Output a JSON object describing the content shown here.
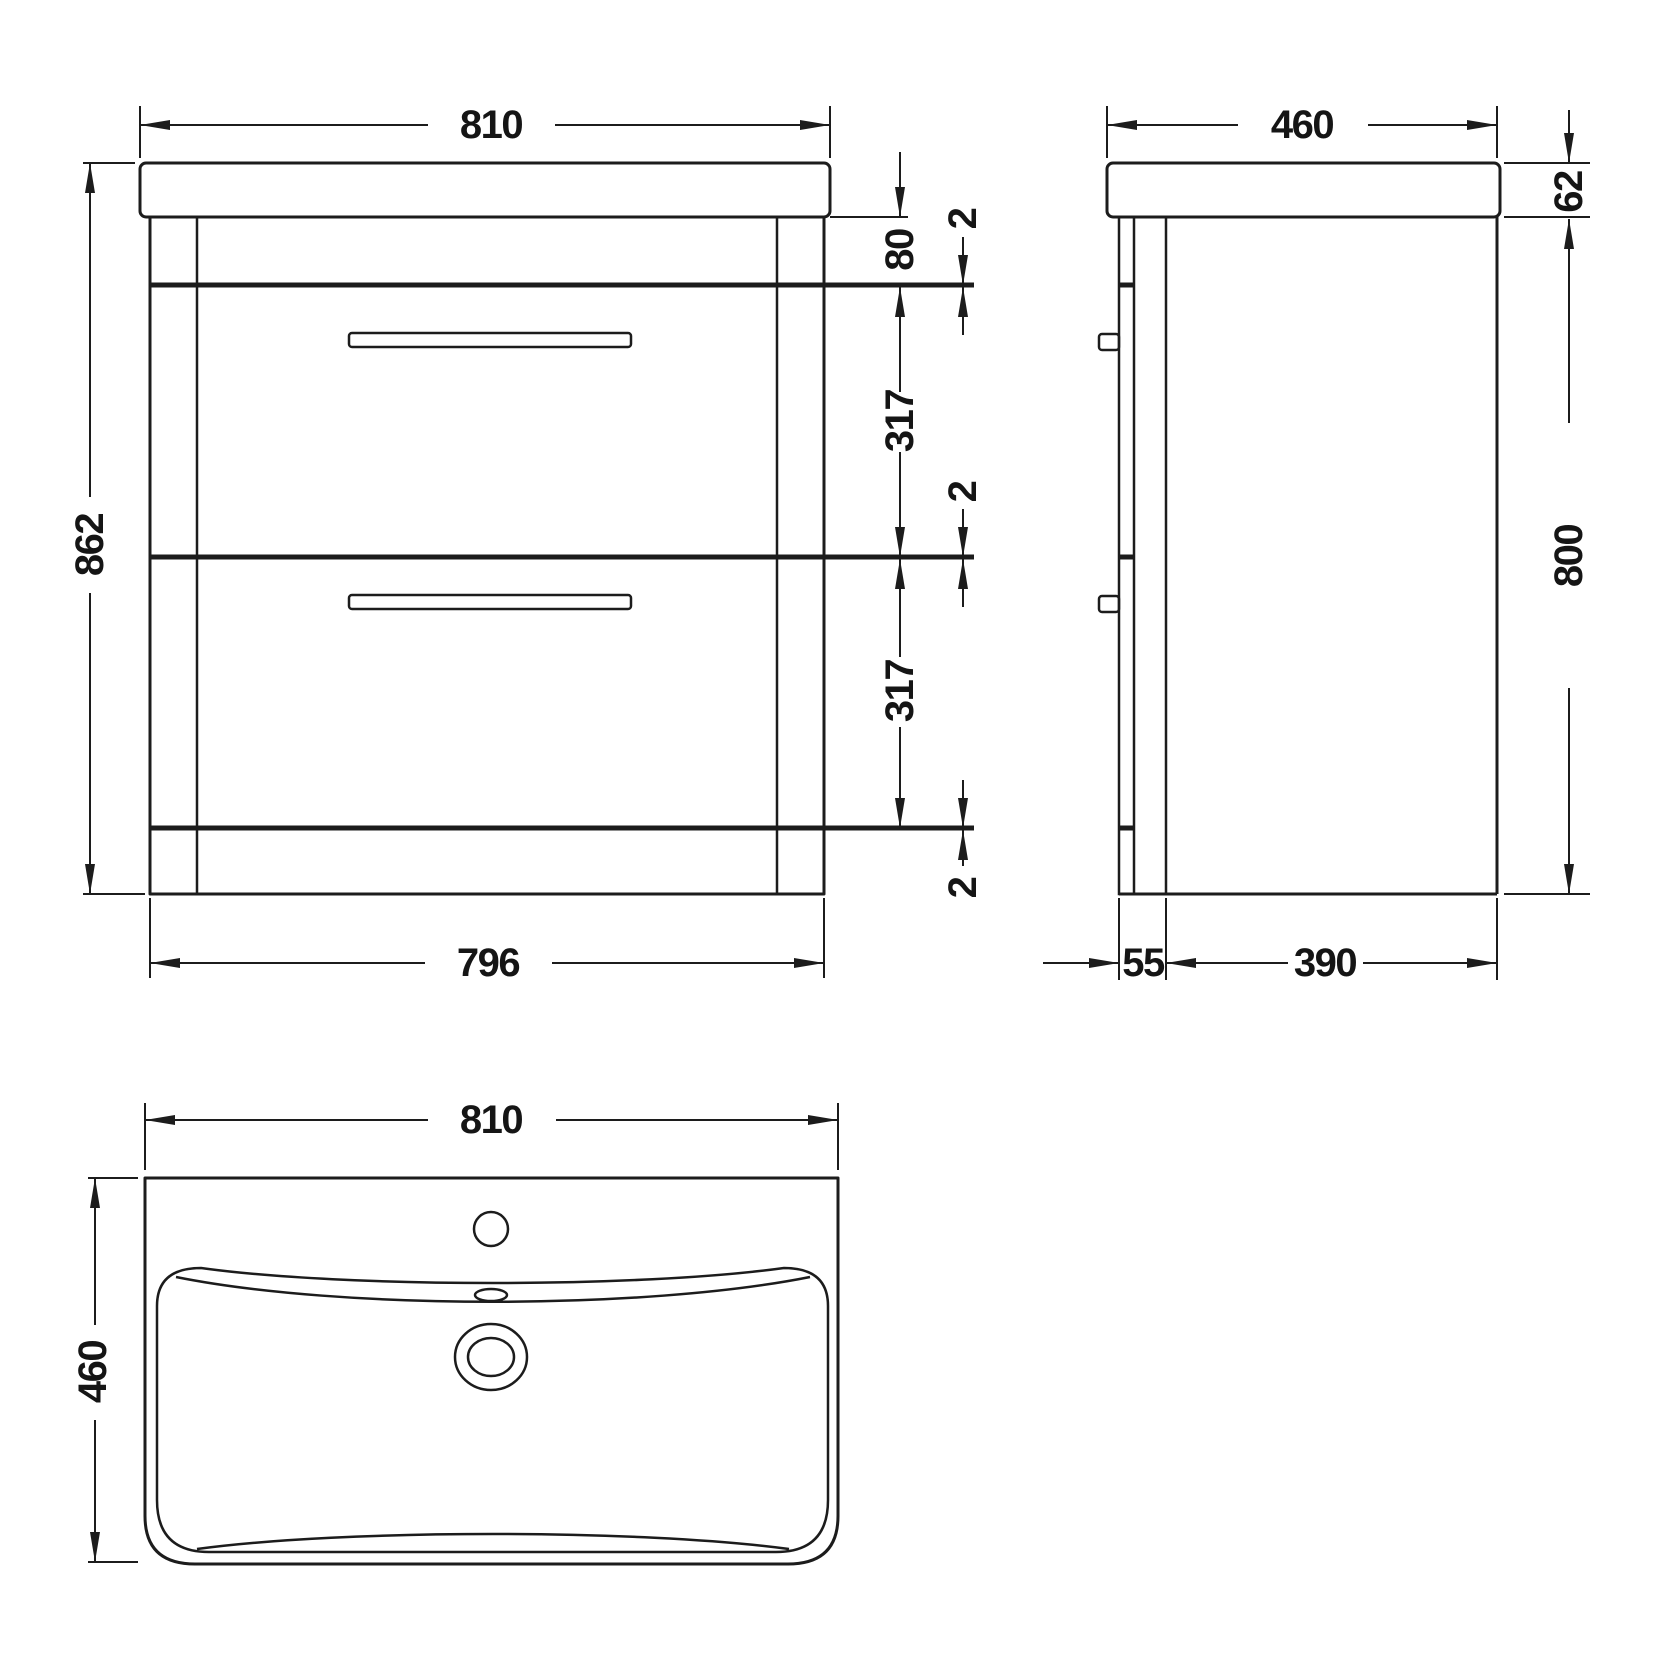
{
  "drawing_type": "technical-dimension-drawing",
  "subject": "two-drawer vanity unit with basin - front, side and plan views",
  "colors": {
    "line": "#1c1c1c",
    "background": "#ffffff"
  },
  "front": {
    "dim_width_top": "810",
    "dim_height": "862",
    "dim_top_rail": "80",
    "dim_gap_top": "2",
    "dim_drawer1": "317",
    "dim_gap_mid": "2",
    "dim_drawer2": "317",
    "dim_gap_bottom": "2",
    "dim_width_bottom": "796"
  },
  "side": {
    "dim_depth": "460",
    "dim_counter_thickness": "62",
    "dim_body_height": "800",
    "dim_front_offset": "55",
    "dim_body_depth": "390"
  },
  "top": {
    "dim_width": "810",
    "dim_depth": "460"
  }
}
